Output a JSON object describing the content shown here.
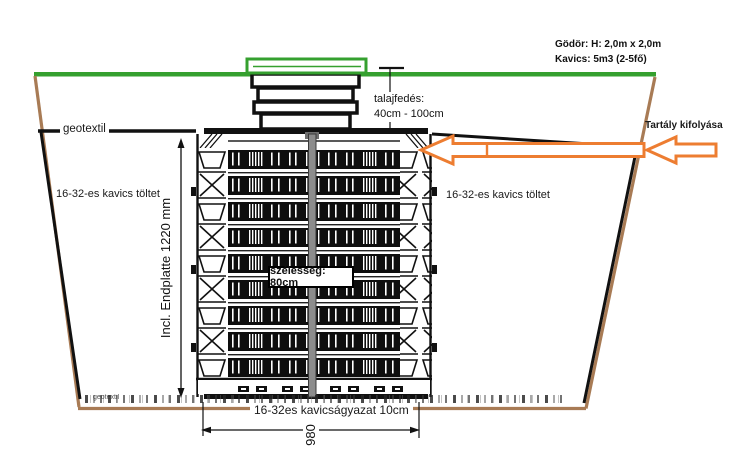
{
  "drawing": {
    "pit_info": {
      "line1": "Gödör: H: 2,0m x 2,0m",
      "line2": "Kavics: 5m3 (2-5fő)"
    },
    "soil_cover": {
      "line1": "talajfedés:",
      "line2": "40cm - 100cm"
    },
    "geotextile_top": "geotextil",
    "geotextile_bottom": "geotextil",
    "gravel_fill_left": "16-32-es kavics töltet",
    "gravel_fill_right": "16-32-es kavics töltet",
    "width_label": "szélesség: 80cm",
    "height_dimension": "Incl. Endplatte 1220 mm",
    "tank_outflow": "Tartály kifolyása",
    "gravel_bed": "16-32es kavicságyazat 10cm",
    "width_dimension": "980",
    "colors": {
      "ground_green": "#35A02F",
      "arrow_orange": "#ED7D31",
      "pit_brown": "#A87B55",
      "line_black": "#111111"
    }
  }
}
